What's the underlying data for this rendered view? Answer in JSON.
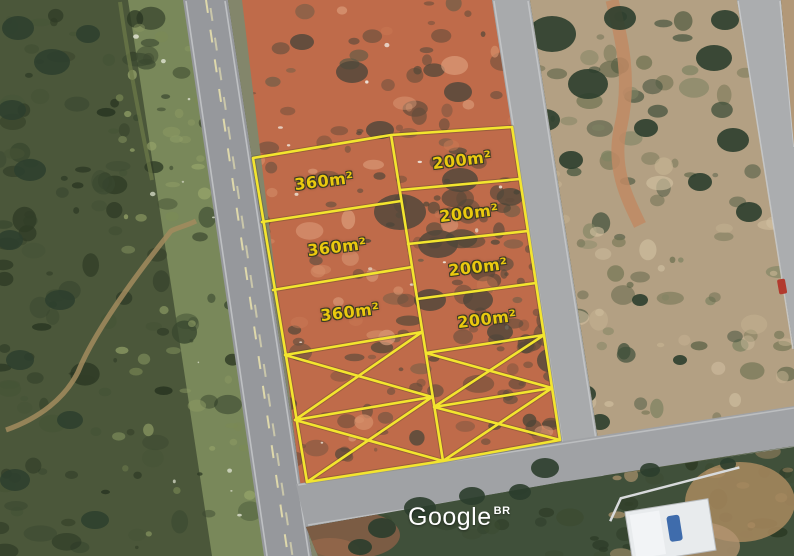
{
  "map": {
    "watermark": {
      "logo": "Google",
      "region_code": "BR"
    },
    "plot_labels": [
      {
        "text": "360m²",
        "x": 324,
        "y": 181,
        "rot": -7
      },
      {
        "text": "360m²",
        "x": 337,
        "y": 247,
        "rot": -7
      },
      {
        "text": "360m²",
        "x": 350,
        "y": 312,
        "rot": -7
      },
      {
        "text": "200m²",
        "x": 462,
        "y": 160,
        "rot": -7
      },
      {
        "text": "200m²",
        "x": 469,
        "y": 213,
        "rot": -7
      },
      {
        "text": "200m²",
        "x": 478,
        "y": 267,
        "rot": -7
      },
      {
        "text": "200m²",
        "x": 487,
        "y": 319,
        "rot": -7
      }
    ],
    "crossed_plots": {
      "left_column": 2,
      "right_column": 2,
      "mark": "X"
    },
    "colors": {
      "plot_line": "#f3e52e",
      "plot_label": "#eac90e",
      "watermark": "#ffffff"
    }
  }
}
